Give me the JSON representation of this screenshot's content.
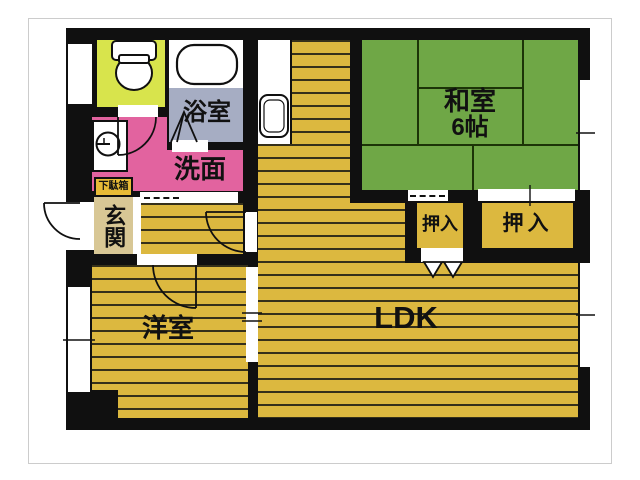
{
  "rooms": {
    "washitsu": {
      "label": "和室",
      "size": "6帖"
    },
    "oshiire_left": {
      "label": "押入"
    },
    "oshiire_right": {
      "label": "押入"
    },
    "ldk": {
      "label": "LDK"
    },
    "youshitsu": {
      "label": "洋室"
    },
    "senmen": {
      "label": "洗面"
    },
    "yokushitsu": {
      "label": "浴室"
    },
    "genkan": {
      "label": "玄関"
    },
    "getabako": {
      "label": "下駄箱"
    }
  },
  "icons": {
    "toilet": "toilet-icon",
    "bathtub": "bathtub-icon",
    "kitchen_sink": "kitchen-sink-icon",
    "washing_machine": "washing-machine-icon",
    "door_swing": "door-swing-arc-icon",
    "folding_door": "folding-door-icon",
    "sliding_door": "sliding-door-dashed-icon"
  },
  "colors": {
    "wall": "#101010",
    "flooring": "#dcb83f",
    "flooring_line": "#35301a",
    "tatami_green": "#6fa746",
    "washroom_pink": "#e2639f",
    "bathroom_gray": "#a6adc3",
    "toilet_chartreuse": "#d8e44c",
    "entrance_tan": "#d8c795",
    "shoe_cabinet_gold": "#e8bb37",
    "fixture_white": "#ffffff"
  }
}
